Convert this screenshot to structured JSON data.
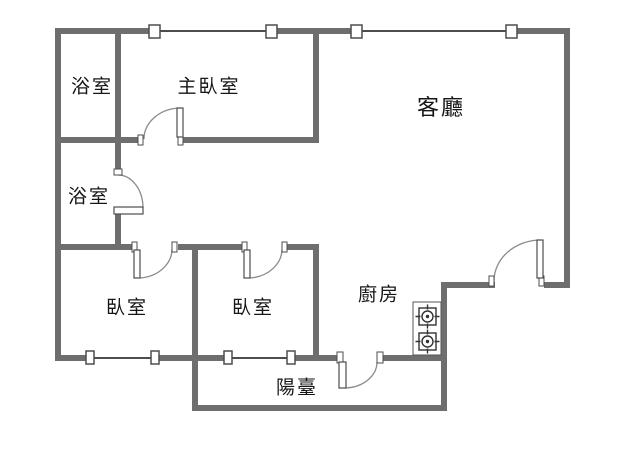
{
  "floorplan": {
    "title": "公寓平面圖",
    "rooms": [
      {
        "id": "bathroom-1",
        "label": "浴室"
      },
      {
        "id": "master-bedroom",
        "label": "主臥室"
      },
      {
        "id": "living-room",
        "label": "客廳"
      },
      {
        "id": "bathroom-2",
        "label": "浴室"
      },
      {
        "id": "bedroom-1",
        "label": "臥室"
      },
      {
        "id": "bedroom-2",
        "label": "臥室"
      },
      {
        "id": "kitchen",
        "label": "廚房"
      },
      {
        "id": "balcony",
        "label": "陽臺"
      }
    ],
    "fixtures": {
      "stove_burners": 2,
      "doors": 6,
      "windows": 8
    },
    "colors": {
      "wall": "#6e6e6e",
      "window_line": "#4d4d4d",
      "door_arc": "#8a8a8a",
      "text": "#161616",
      "background": "#ffffff"
    }
  }
}
